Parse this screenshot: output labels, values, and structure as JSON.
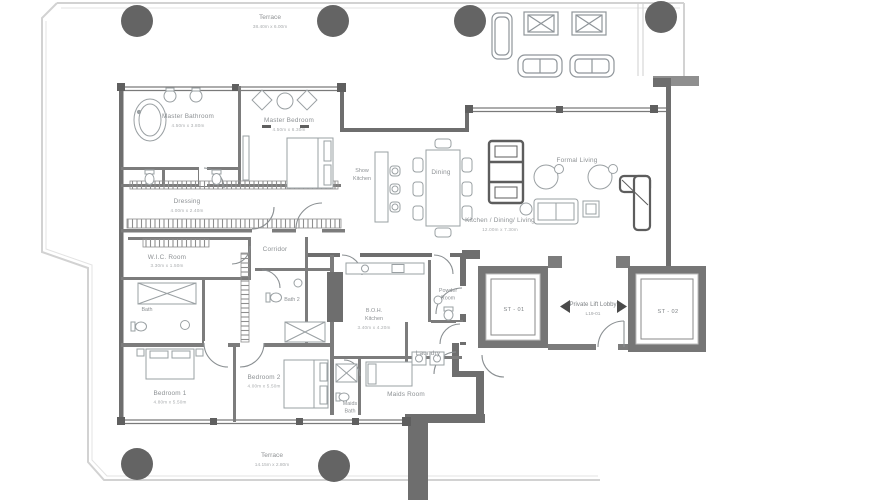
{
  "plan": {
    "type": "residential floor plan",
    "terrace_top": {
      "name": "Terrace",
      "dims": "38.40m x 6.00m"
    },
    "terrace_bottom": {
      "name": "Terrace",
      "dims": "14.15m x 2.80m"
    },
    "rooms": {
      "master_bathroom": {
        "name": "Master Bathroom",
        "dims": "4.50m x 3.80m"
      },
      "master_bedroom": {
        "name": "Master Bedroom",
        "dims": "4.50m x 6.30m"
      },
      "dressing": {
        "name": "Dressing",
        "dims": "4.00m x 2.40m"
      },
      "wic_room": {
        "name": "W.I.C. Room",
        "dims": "3.30m x 1.50m"
      },
      "corridor": {
        "name": "Corridor"
      },
      "bath_1": {
        "name": "Bath"
      },
      "bath_2": {
        "name": "Bath 2"
      },
      "bedroom_1": {
        "name": "Bedroom 1",
        "dims": "4.80m x 5.50m"
      },
      "bedroom_2": {
        "name": "Bedroom 2",
        "dims": "4.00m x 5.50m"
      },
      "show_kitchen": {
        "line1": "Show",
        "line2": "Kitchen"
      },
      "dining": {
        "name": "Dining"
      },
      "formal_living": {
        "name": "Formal Living"
      },
      "kitchen_dining_living": {
        "name": "Kitchen / Dining/ Living",
        "dims": "12.00m x 7.30m"
      },
      "boh_kitchen": {
        "line1": "B.O.H.",
        "line2": "Kitchen",
        "dims": "3.40m x 4.20m"
      },
      "powder_room": {
        "line1": "Powder",
        "line2": "Room"
      },
      "laundry": {
        "name": "Laundry"
      },
      "maids_room": {
        "name": "Maids Room"
      },
      "maids_bath": {
        "line1": "Maids",
        "line2": "Bath"
      },
      "private_lift_lobby": {
        "line1": "Private Lift Lobby",
        "line2": "L19-01"
      },
      "st_01": {
        "name": "ST - 01"
      },
      "st_02": {
        "name": "ST - 02"
      }
    },
    "colors": {
      "wall": "#6e6e6e",
      "wall_interior": "#7c7c7c",
      "shaft_wall": "#767676",
      "column": "#646464",
      "terrace_outline": "#d2d2d2",
      "furniture": "#9aa0a3",
      "label_text": "#8d9194",
      "dims_text": "#a9acae"
    }
  }
}
